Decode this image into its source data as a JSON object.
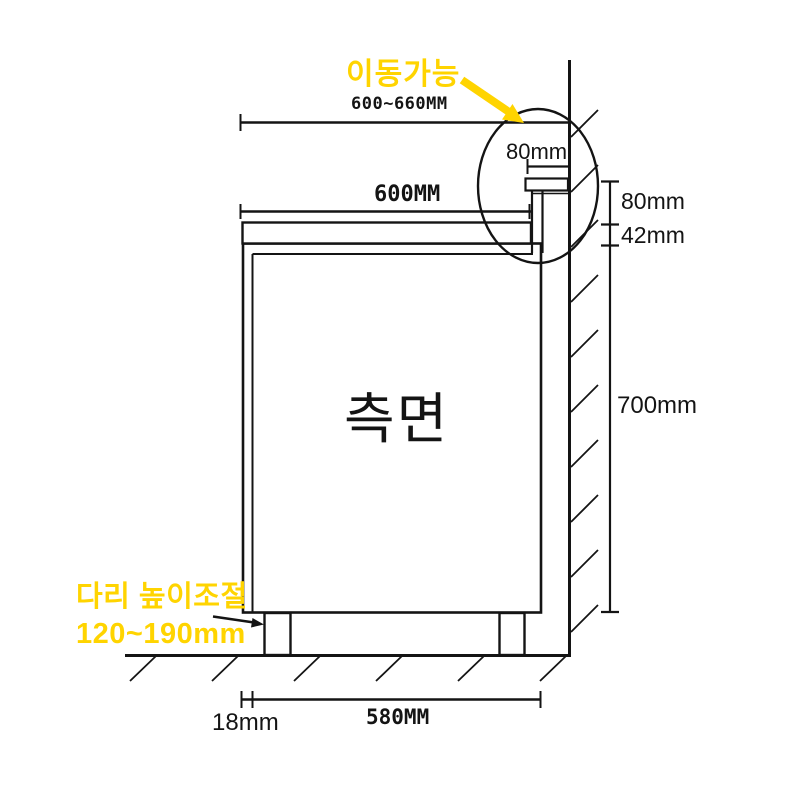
{
  "diagram": {
    "view_label": "측면",
    "colors": {
      "line": "#141414",
      "accent": "#ffd400",
      "background": "#ffffff"
    },
    "annotations": {
      "movable": "이동가능",
      "leg_adjust_line1": "다리 높이조절",
      "leg_adjust_line2": "120~190mm"
    },
    "dimensions": {
      "overall_depth": "600~660MM",
      "tabletop_depth": "600MM",
      "rail_width": "80mm",
      "rail_offset_height": "80mm",
      "top_thickness": "42mm",
      "body_height": "700mm",
      "panel_thickness": "18mm",
      "inner_width": "580MM"
    }
  }
}
